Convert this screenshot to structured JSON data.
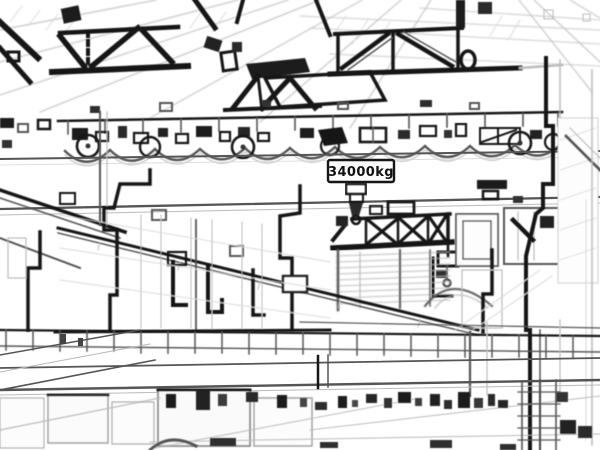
{
  "window": {
    "width_px": 600,
    "height_px": 450
  },
  "scene": {
    "style": "pencil-sketch / edge-detected line drawing",
    "subject": "industrial factory hall interior: roof trusses, overhead bridge crane, auxiliary crane, walkways, columns and floor machinery",
    "background_color": "#ffffff",
    "ink_dark": "#161616",
    "ink_mid": "#555555",
    "ink_light": "#bbbbbb"
  },
  "main_crane": {
    "capacity_label": "34000kg",
    "label_background": "#fcfcfc",
    "label_border": "#161616"
  }
}
